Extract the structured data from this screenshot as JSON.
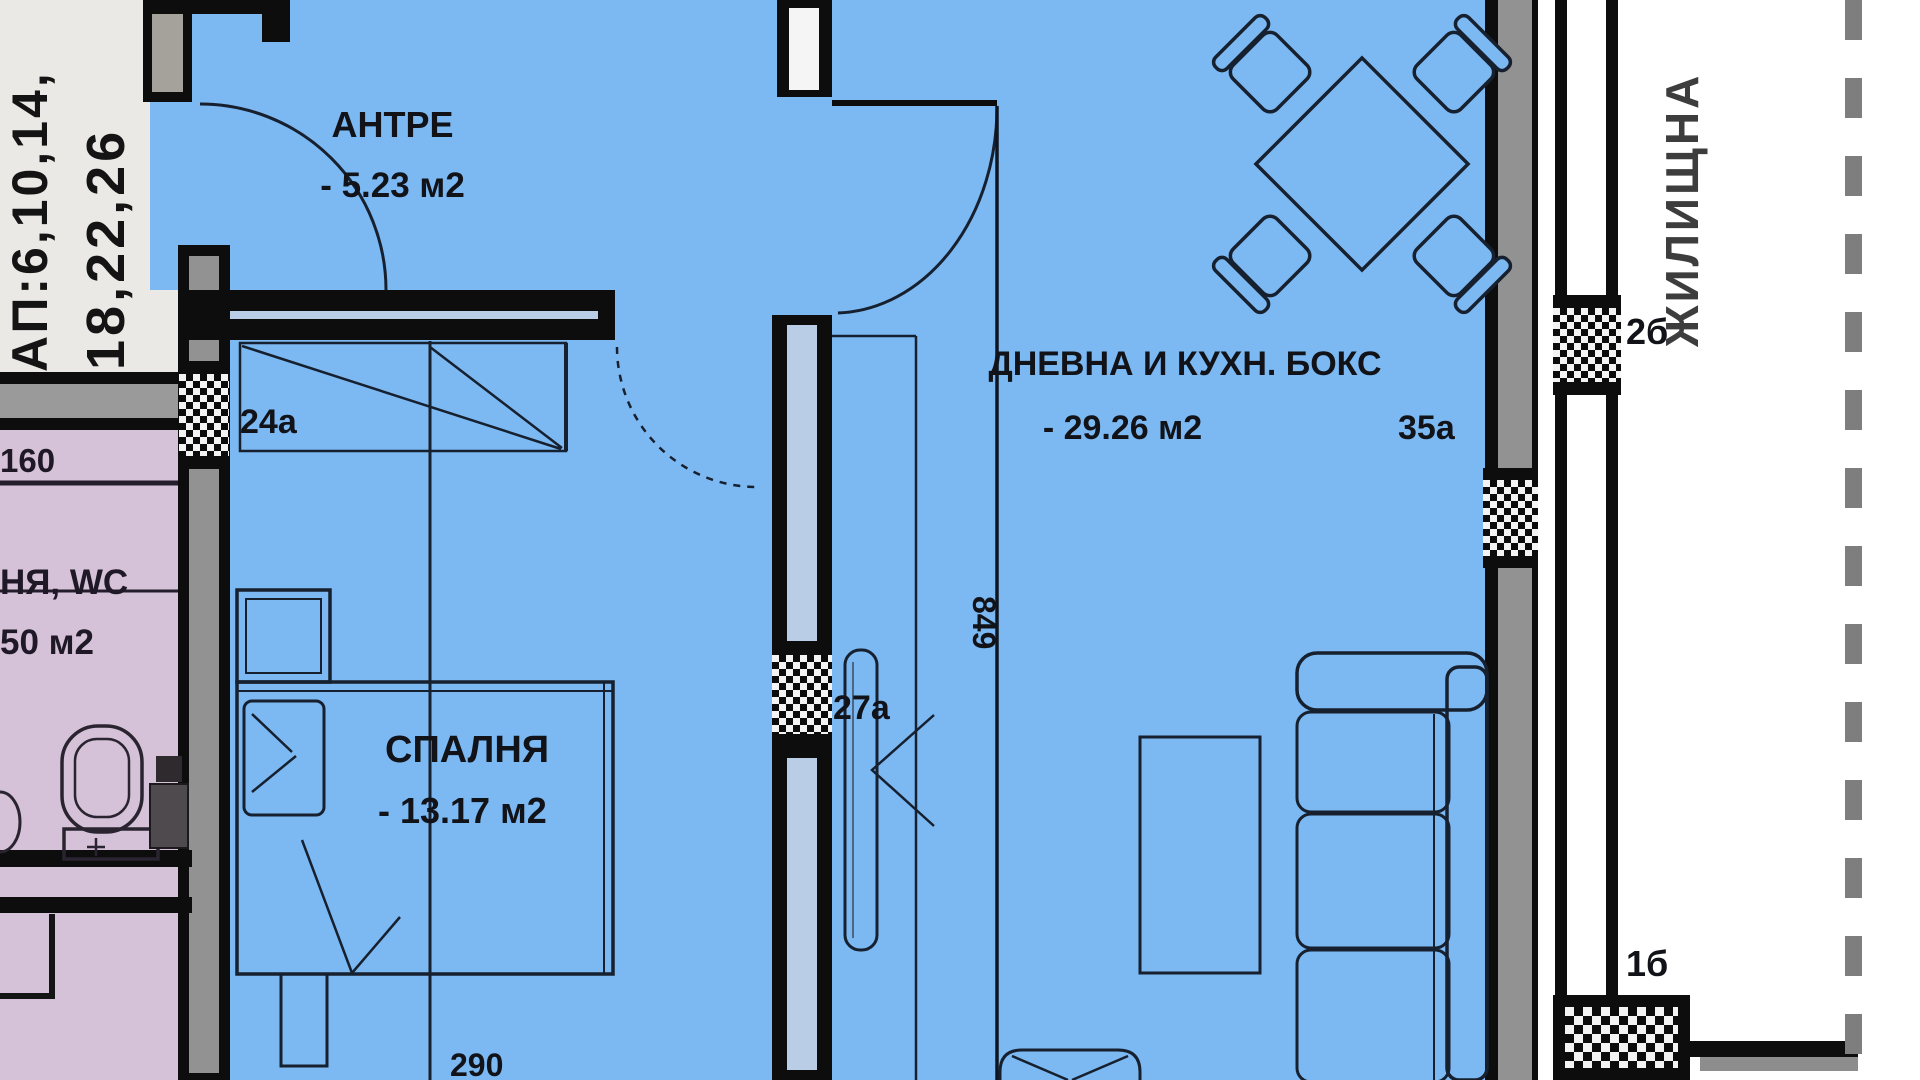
{
  "colors": {
    "room_blue": "#7cb8f2",
    "neighbor_pink": "#d6c2d8",
    "margin_gray": "#ebe9e6",
    "wall_black": "#0d0d0d",
    "poche_gray": "#929292",
    "dash_gray": "#7e7e7e"
  },
  "left_strip": {
    "apartments_line1": "АП:6,10,14,",
    "apartments_line2": "18,22,26"
  },
  "neighbor_unit": {
    "dim_160": "160",
    "room_name": "НЯ, WC",
    "room_area": "50 м2"
  },
  "rooms": {
    "antre": {
      "name": "АНТРЕ",
      "area": "- 5.23 м2"
    },
    "bedroom": {
      "name": "СПАЛНЯ",
      "area": "- 13.17 м2"
    },
    "living": {
      "name": "ДНЕВНА И КУХН. БОКС",
      "area": "- 29.26 м2"
    }
  },
  "openings": {
    "window_24a": "24а",
    "door_27a": "27а",
    "window_35a": "35а",
    "window_2b": "2б",
    "column_1b": "1б"
  },
  "dimensions": {
    "d849": "849",
    "d290": "290"
  },
  "right_zone": {
    "label": "ЖИЛИЩНА"
  }
}
